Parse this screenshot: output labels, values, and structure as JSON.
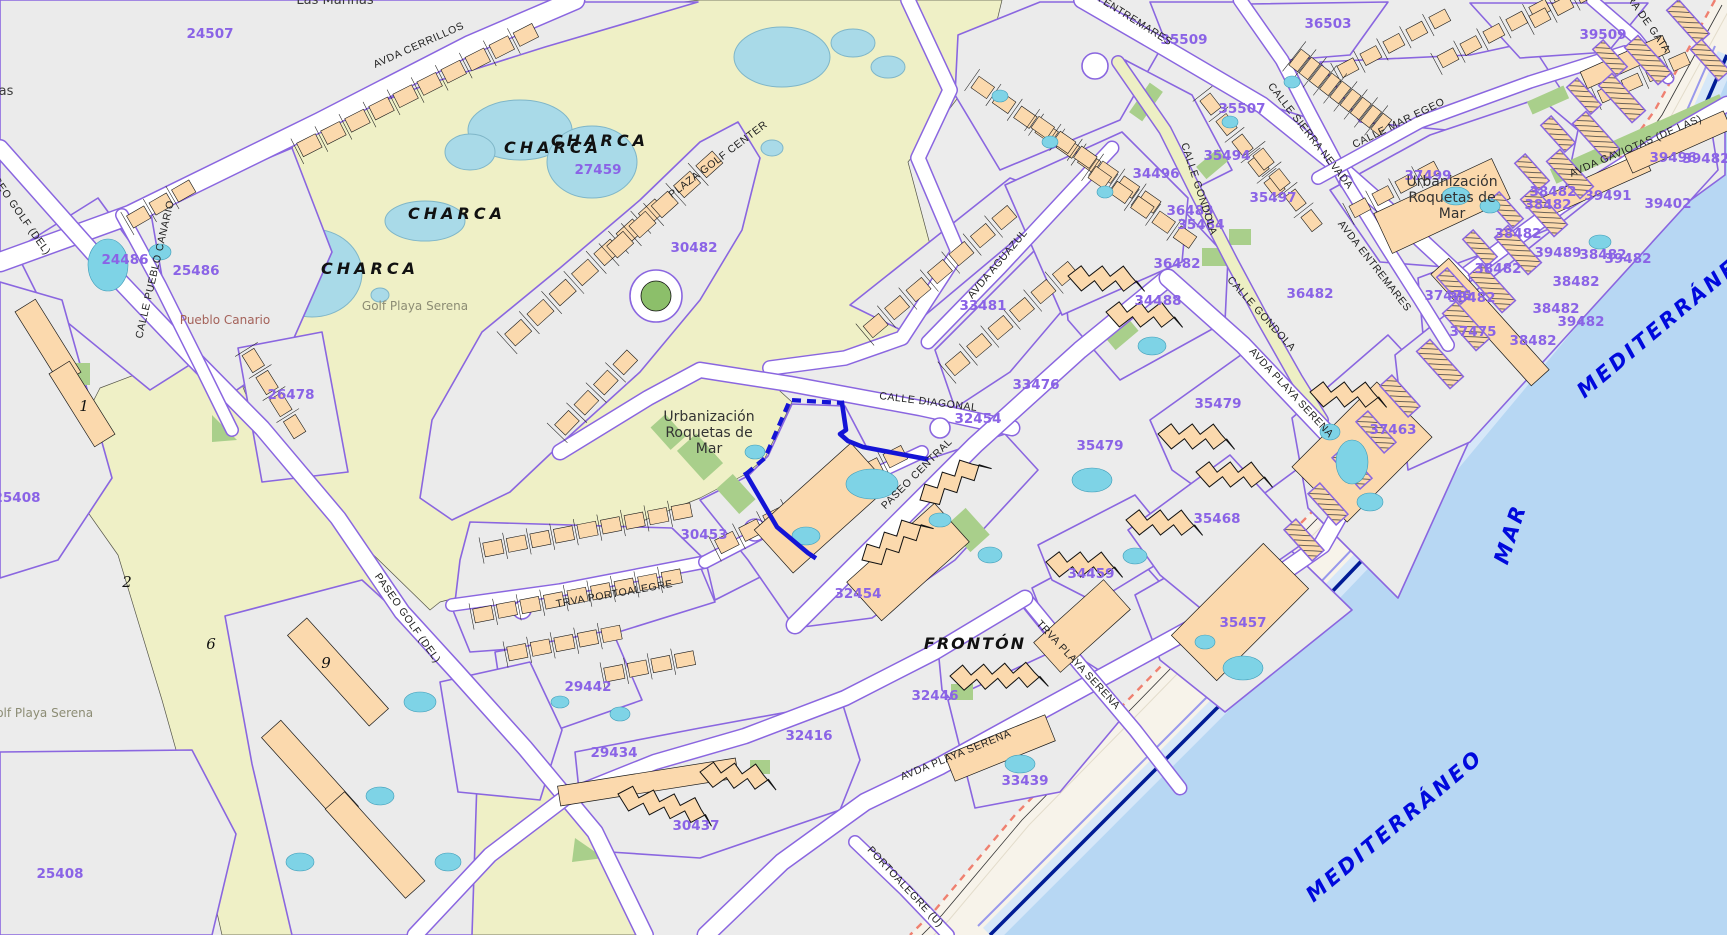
{
  "map": {
    "colors": {
      "parcel_boundary": "#8A66E0",
      "parcel_label": "#8A63E6",
      "selection": "#1414D6",
      "sea_label": "#0009DD",
      "golf_fill": "#EFF0C6",
      "sea_fill": "#B7D7F3",
      "building_fill": "#FBD9AD",
      "pool_fill": "#7ED3E6",
      "sand_fill": "#F7F3EA",
      "coast_line": "#001C96",
      "green_fill": "#A9CF8B",
      "place_brown": "#A4625A"
    },
    "labels": {
      "parcel_numbers": [
        {
          "text": "24507",
          "x": 210,
          "y": 38
        },
        {
          "text": "24486",
          "x": 125,
          "y": 264
        },
        {
          "text": "25486",
          "x": 196,
          "y": 275
        },
        {
          "text": "27459",
          "x": 598,
          "y": 174
        },
        {
          "text": "26478",
          "x": 291,
          "y": 399
        },
        {
          "text": "25408",
          "x": 17,
          "y": 502
        },
        {
          "text": "25408",
          "x": 60,
          "y": 878
        },
        {
          "text": "30482",
          "x": 694,
          "y": 252
        },
        {
          "text": "30453",
          "x": 704,
          "y": 539
        },
        {
          "text": "29442",
          "x": 588,
          "y": 691
        },
        {
          "text": "29434",
          "x": 614,
          "y": 757
        },
        {
          "text": "30437",
          "x": 696,
          "y": 830
        },
        {
          "text": "32454",
          "x": 978,
          "y": 423
        },
        {
          "text": "32454",
          "x": 858,
          "y": 598
        },
        {
          "text": "32446",
          "x": 935,
          "y": 700
        },
        {
          "text": "32416",
          "x": 809,
          "y": 740
        },
        {
          "text": "33439",
          "x": 1025,
          "y": 785
        },
        {
          "text": "33481",
          "x": 983,
          "y": 310
        },
        {
          "text": "33476",
          "x": 1036,
          "y": 389
        },
        {
          "text": "34488",
          "x": 1158,
          "y": 305
        },
        {
          "text": "34496",
          "x": 1156,
          "y": 178
        },
        {
          "text": "34459",
          "x": 1091,
          "y": 578
        },
        {
          "text": "35457",
          "x": 1243,
          "y": 627
        },
        {
          "text": "35468",
          "x": 1217,
          "y": 523
        },
        {
          "text": "35479",
          "x": 1218,
          "y": 408
        },
        {
          "text": "35479",
          "x": 1100,
          "y": 450
        },
        {
          "text": "35509",
          "x": 1184,
          "y": 44
        },
        {
          "text": "35507",
          "x": 1242,
          "y": 113
        },
        {
          "text": "35494",
          "x": 1227,
          "y": 160
        },
        {
          "text": "35497",
          "x": 1273,
          "y": 202
        },
        {
          "text": "36483",
          "x": 1190,
          "y": 215
        },
        {
          "text": "35484",
          "x": 1201,
          "y": 229
        },
        {
          "text": "36482",
          "x": 1177,
          "y": 268
        },
        {
          "text": "36482",
          "x": 1310,
          "y": 298
        },
        {
          "text": "36503",
          "x": 1328,
          "y": 28
        },
        {
          "text": "39509",
          "x": 1603,
          "y": 39
        },
        {
          "text": "37499",
          "x": 1428,
          "y": 180
        },
        {
          "text": "37475",
          "x": 1473,
          "y": 336
        },
        {
          "text": "37476",
          "x": 1448,
          "y": 300
        },
        {
          "text": "38482",
          "x": 1472,
          "y": 302
        },
        {
          "text": "37463",
          "x": 1393,
          "y": 434
        },
        {
          "text": "38482",
          "x": 1518,
          "y": 238
        },
        {
          "text": "38482",
          "x": 1498,
          "y": 273
        },
        {
          "text": "39489",
          "x": 1558,
          "y": 257
        },
        {
          "text": "38482",
          "x": 1603,
          "y": 259
        },
        {
          "text": "39482",
          "x": 1628,
          "y": 263
        },
        {
          "text": "38482",
          "x": 1576,
          "y": 286
        },
        {
          "text": "38482",
          "x": 1556,
          "y": 313
        },
        {
          "text": "39482",
          "x": 1581,
          "y": 326
        },
        {
          "text": "38482",
          "x": 1533,
          "y": 345
        },
        {
          "text": "39491",
          "x": 1608,
          "y": 200
        },
        {
          "text": "38482",
          "x": 1553,
          "y": 196
        },
        {
          "text": "38482",
          "x": 1548,
          "y": 209
        },
        {
          "text": "39496",
          "x": 1673,
          "y": 162
        },
        {
          "text": "39482",
          "x": 1706,
          "y": 163
        },
        {
          "text": "39402",
          "x": 1668,
          "y": 208
        }
      ],
      "street_names": [
        {
          "text": "AVDA CERRILLOS",
          "x": 420,
          "y": 48,
          "rot": -24
        },
        {
          "text": "PASEO GOLF (DEL)",
          "x": 15,
          "y": 212,
          "rot": 55
        },
        {
          "text": "PASEO GOLF (DEL)",
          "x": 405,
          "y": 620,
          "rot": 55
        },
        {
          "text": "CALLE PUEBLO CANARIO",
          "x": 158,
          "y": 270,
          "rot": -77
        },
        {
          "text": "PLAZA GOLF CENTER",
          "x": 720,
          "y": 162,
          "rot": -37
        },
        {
          "text": "AVDA ENTREMARES",
          "x": 1122,
          "y": 16,
          "rot": 32
        },
        {
          "text": "AVDA ENTREMARES",
          "x": 1372,
          "y": 268,
          "rot": 52
        },
        {
          "text": "CALLE GONDOLA",
          "x": 1196,
          "y": 190,
          "rot": 72
        },
        {
          "text": "CALLE GONDOLA",
          "x": 1259,
          "y": 316,
          "rot": 48
        },
        {
          "text": "CALLE SIERRA NEVADA",
          "x": 1308,
          "y": 138,
          "rot": 52
        },
        {
          "text": "CALLE MAR EGEO",
          "x": 1400,
          "y": 126,
          "rot": -26
        },
        {
          "text": "RA DE GATA",
          "x": 1646,
          "y": 26,
          "rot": 55
        },
        {
          "text": "AVDA GAVIOTAS (DE LAS)",
          "x": 1637,
          "y": 149,
          "rot": -23
        },
        {
          "text": "AVDA AGUAZUL",
          "x": 1000,
          "y": 266,
          "rot": -50
        },
        {
          "text": "CALLE DIAGONAL",
          "x": 928,
          "y": 405,
          "rot": 7
        },
        {
          "text": "PASEO CENTRAL",
          "x": 919,
          "y": 476,
          "rot": -45
        },
        {
          "text": "TRVA PORTOALEGRE",
          "x": 615,
          "y": 597,
          "rot": -10
        },
        {
          "text": "AVDA PLAYA SERENA",
          "x": 1289,
          "y": 395,
          "rot": 47
        },
        {
          "text": "AVDA PLAYA SERENA",
          "x": 957,
          "y": 758,
          "rot": -22
        },
        {
          "text": "TRVA PLAYA SERENA",
          "x": 1076,
          "y": 667,
          "rot": 47
        },
        {
          "text": "PORTOALEGRE (U)",
          "x": 903,
          "y": 889,
          "rot": 47
        }
      ],
      "place_names": [
        {
          "text": "Las Marinas",
          "x": 335,
          "y": 4,
          "rot": 0,
          "cls": "lbl-place"
        },
        {
          "text": "as",
          "x": 6,
          "y": 95,
          "rot": 0,
          "cls": "lbl-place"
        },
        {
          "text": "Pueblo Canario",
          "x": 225,
          "y": 324,
          "rot": 0,
          "cls": "lbl-brown"
        },
        {
          "text": "Golf Playa Serena",
          "x": 415,
          "y": 310,
          "rot": 0,
          "cls": "lbl-golfname"
        },
        {
          "text": "Golf Playa Serena",
          "x": 40,
          "y": 717,
          "rot": 0,
          "cls": "lbl-golfname"
        },
        {
          "text": "Urbanización\nRoquetas de\nMar",
          "x": 709,
          "y": 421,
          "rot": 0,
          "cls": "lbl-place-lg"
        },
        {
          "text": "Urbanización\nRoquetas de\nMar",
          "x": 1452,
          "y": 186,
          "rot": 0,
          "cls": "lbl-place-lg"
        },
        {
          "text": "CHARCA",
          "x": 600,
          "y": 146,
          "rot": 0,
          "cls": "lbl-charca"
        },
        {
          "text": "CHARCA",
          "x": 553,
          "y": 153,
          "rot": 0,
          "cls": "lbl-charca"
        },
        {
          "text": "CHARCA",
          "x": 457,
          "y": 219,
          "rot": 0,
          "cls": "lbl-charca"
        },
        {
          "text": "CHARCA",
          "x": 370,
          "y": 274,
          "rot": 0,
          "cls": "lbl-charca"
        },
        {
          "text": "FRONTÓN",
          "x": 975,
          "y": 649,
          "rot": 0,
          "cls": "lbl-fronton"
        }
      ],
      "water_names": [
        {
          "text": "MEDITERRÁNEO",
          "x": 1670,
          "y": 327,
          "rot": -40
        },
        {
          "text": "MEDITERRÁNEO",
          "x": 1399,
          "y": 831,
          "rot": -40
        },
        {
          "text": "MAR",
          "x": 1517,
          "y": 536,
          "rot": -72
        }
      ],
      "golf_hole_numbers": [
        {
          "text": "1",
          "x": 84,
          "y": 411
        },
        {
          "text": "2",
          "x": 127,
          "y": 587
        },
        {
          "text": "6",
          "x": 211,
          "y": 649
        },
        {
          "text": "9",
          "x": 326,
          "y": 668
        }
      ]
    }
  }
}
